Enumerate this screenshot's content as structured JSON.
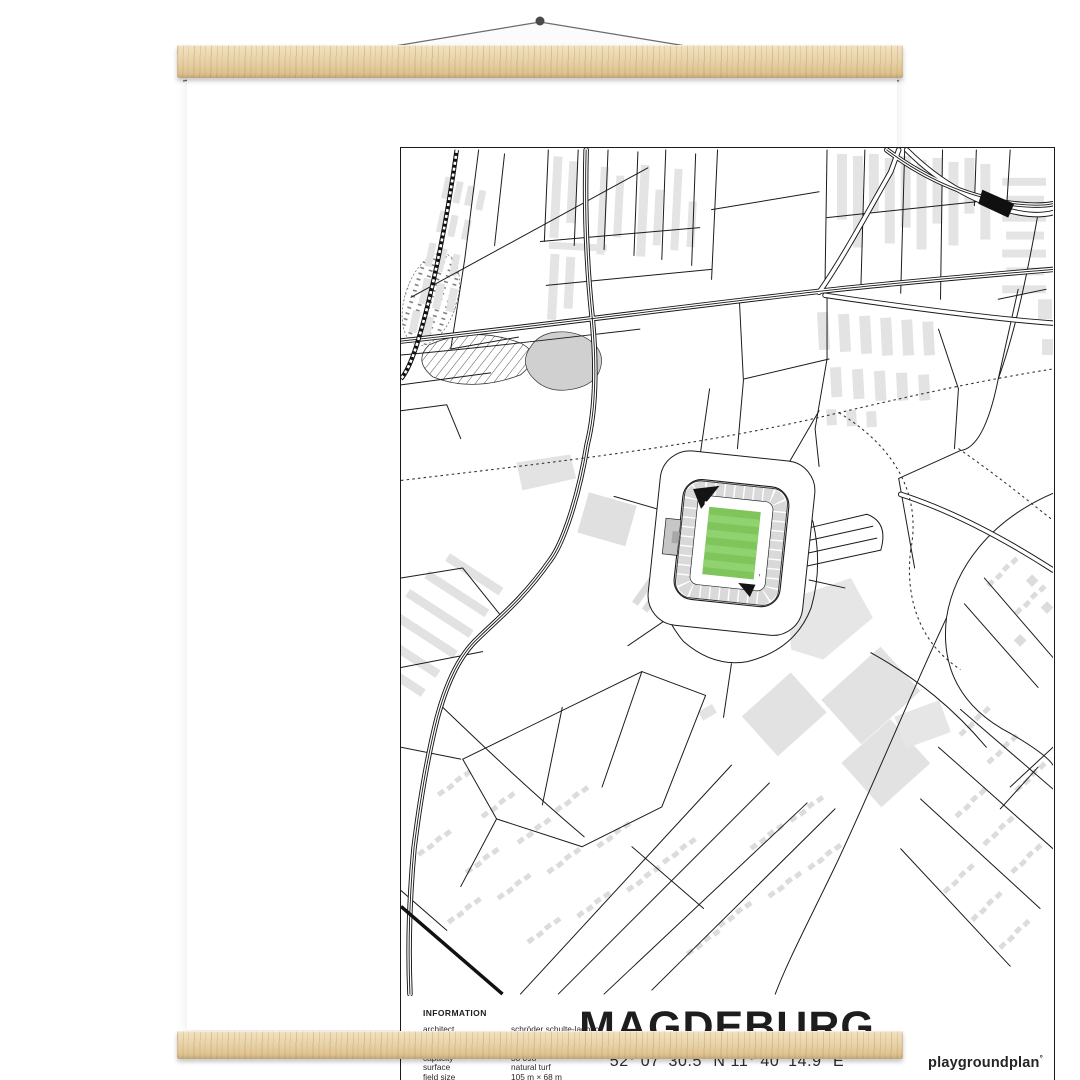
{
  "poster": {
    "title": "MAGDEBURG",
    "coordinates": "52° 07' 30.5\" N 11° 40' 14.9\" E",
    "brand": "playgroundplan",
    "brand_mark": "°",
    "info": {
      "heading": "INFORMATION",
      "rows": [
        {
          "label": "architect",
          "value": "schröder schulte-ladbeck"
        },
        {
          "label": "year",
          "value": "2006"
        },
        {
          "label": "location",
          "value": "heinz-krügel-platz 1"
        },
        {
          "label": "capacity",
          "value": "30 098"
        },
        {
          "label": "surface",
          "value": "natural turf"
        },
        {
          "label": "field size",
          "value": "105 m × 68 m"
        }
      ]
    },
    "colors": {
      "pitch_green": "#7fc55b",
      "pitch_stripe_light": "#90d170",
      "stand_gray": "#d9d9d9",
      "map_line": "#1b1b1b",
      "wood": "#e9d4ac",
      "paper": "#ffffff"
    }
  },
  "hanger": {
    "type": "wooden poster hanger",
    "parts": [
      "top bar",
      "bottom bar",
      "string",
      "wall pin"
    ]
  }
}
